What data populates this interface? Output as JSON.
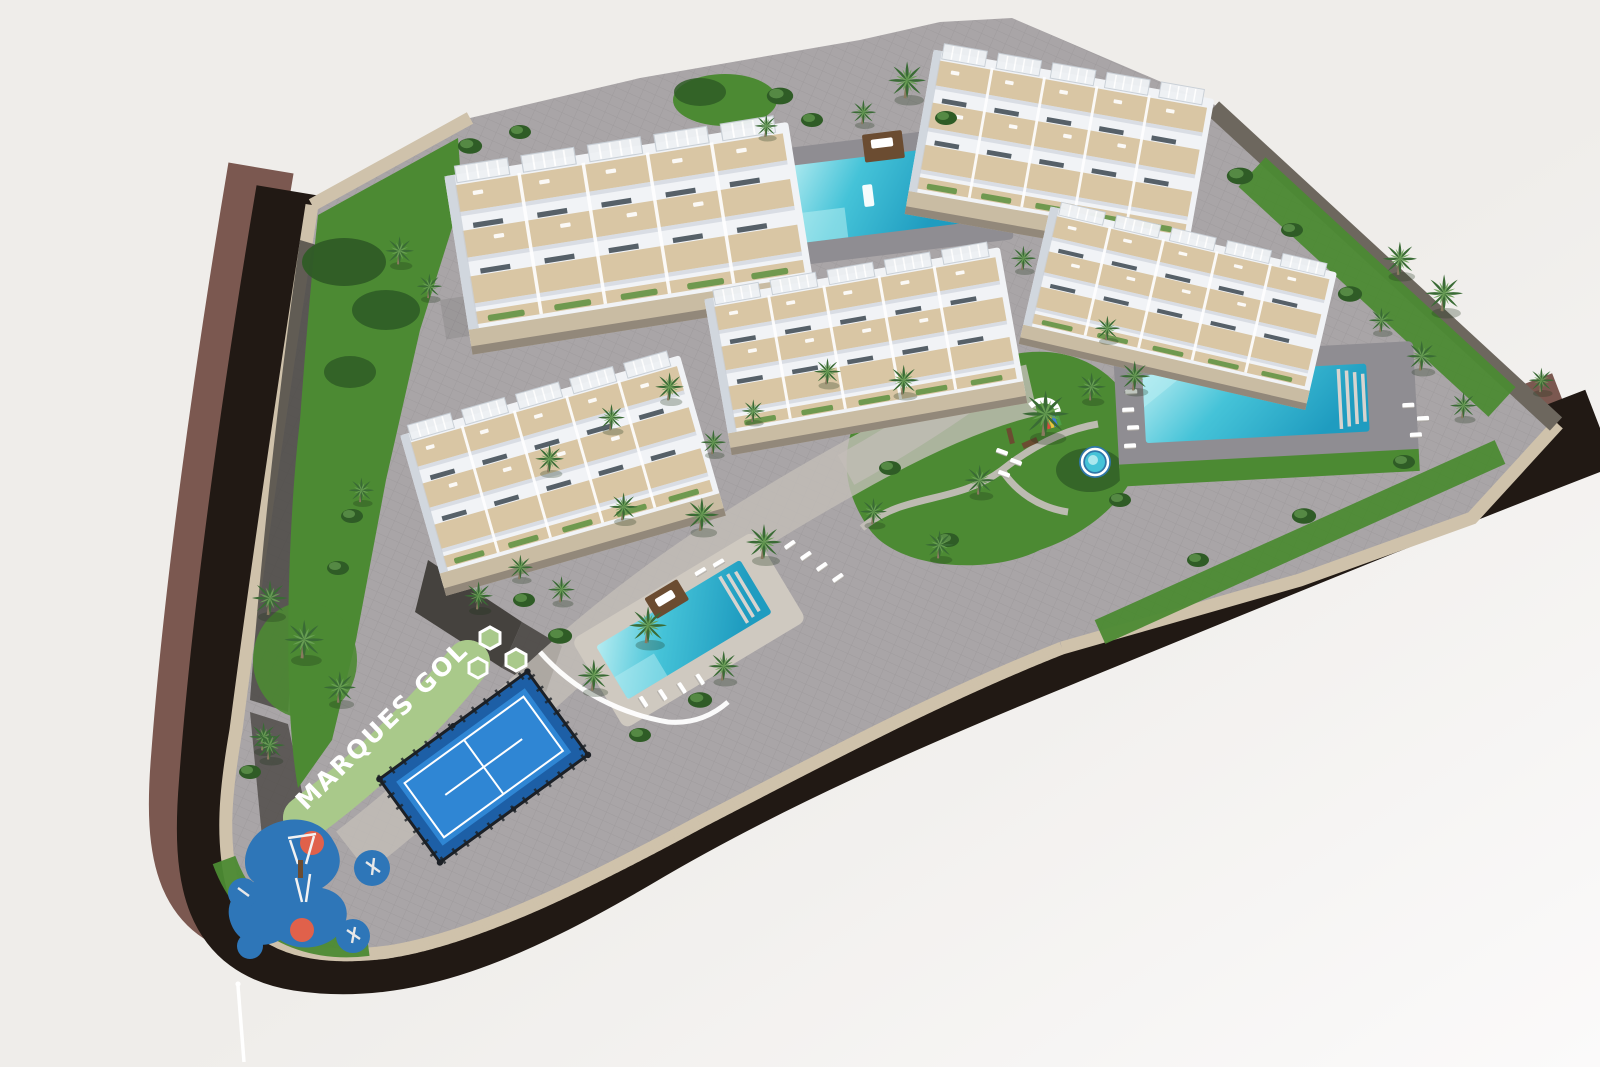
{
  "scene": {
    "sign_label": "MARQUES GOLF"
  },
  "features": {
    "apartment_blocks": 5,
    "swimming_pools": 3,
    "kids_pools": 1,
    "padel_courts": 1,
    "playgrounds": 1
  },
  "colors": {
    "bg_top": "#efedea",
    "bg_bottom": "#fbfafa",
    "road": "#211914",
    "sidewalk": "#7b5850",
    "boundary_wall": "#cfc2ab",
    "wall_dark": "#6d675e",
    "stone_dark": "#45423e",
    "paving": "#a9a5a7",
    "paving_light": "#c3beb8",
    "deck_grey": "#8f8d92",
    "deck_light": "#cfc9c0",
    "grass": "#4c8a33",
    "grass_dark": "#2f5c26",
    "hedge": "#a9c98b",
    "palm": "#3a6b35",
    "palm_light": "#6aa155",
    "trunk": "#8a7a60",
    "pool": "#45c3d8",
    "pool_light": "#b5ecf1",
    "pool_deep": "#1f9cc0",
    "wood": "#6b4c31",
    "building": "#f1f3f6",
    "building_shade": "#c9cfd8",
    "terrace": "#d9c6a4",
    "window_dark": "#3c4750",
    "podium": "#c9bca3",
    "podium_dark": "#8c8275",
    "padel_court": "#2f86d4",
    "padel_border": "#1d5fa6",
    "fence": "#1c2026",
    "play_blue": "#2e76b8",
    "play_orange": "#e0614b",
    "sign": "#ffffff"
  }
}
